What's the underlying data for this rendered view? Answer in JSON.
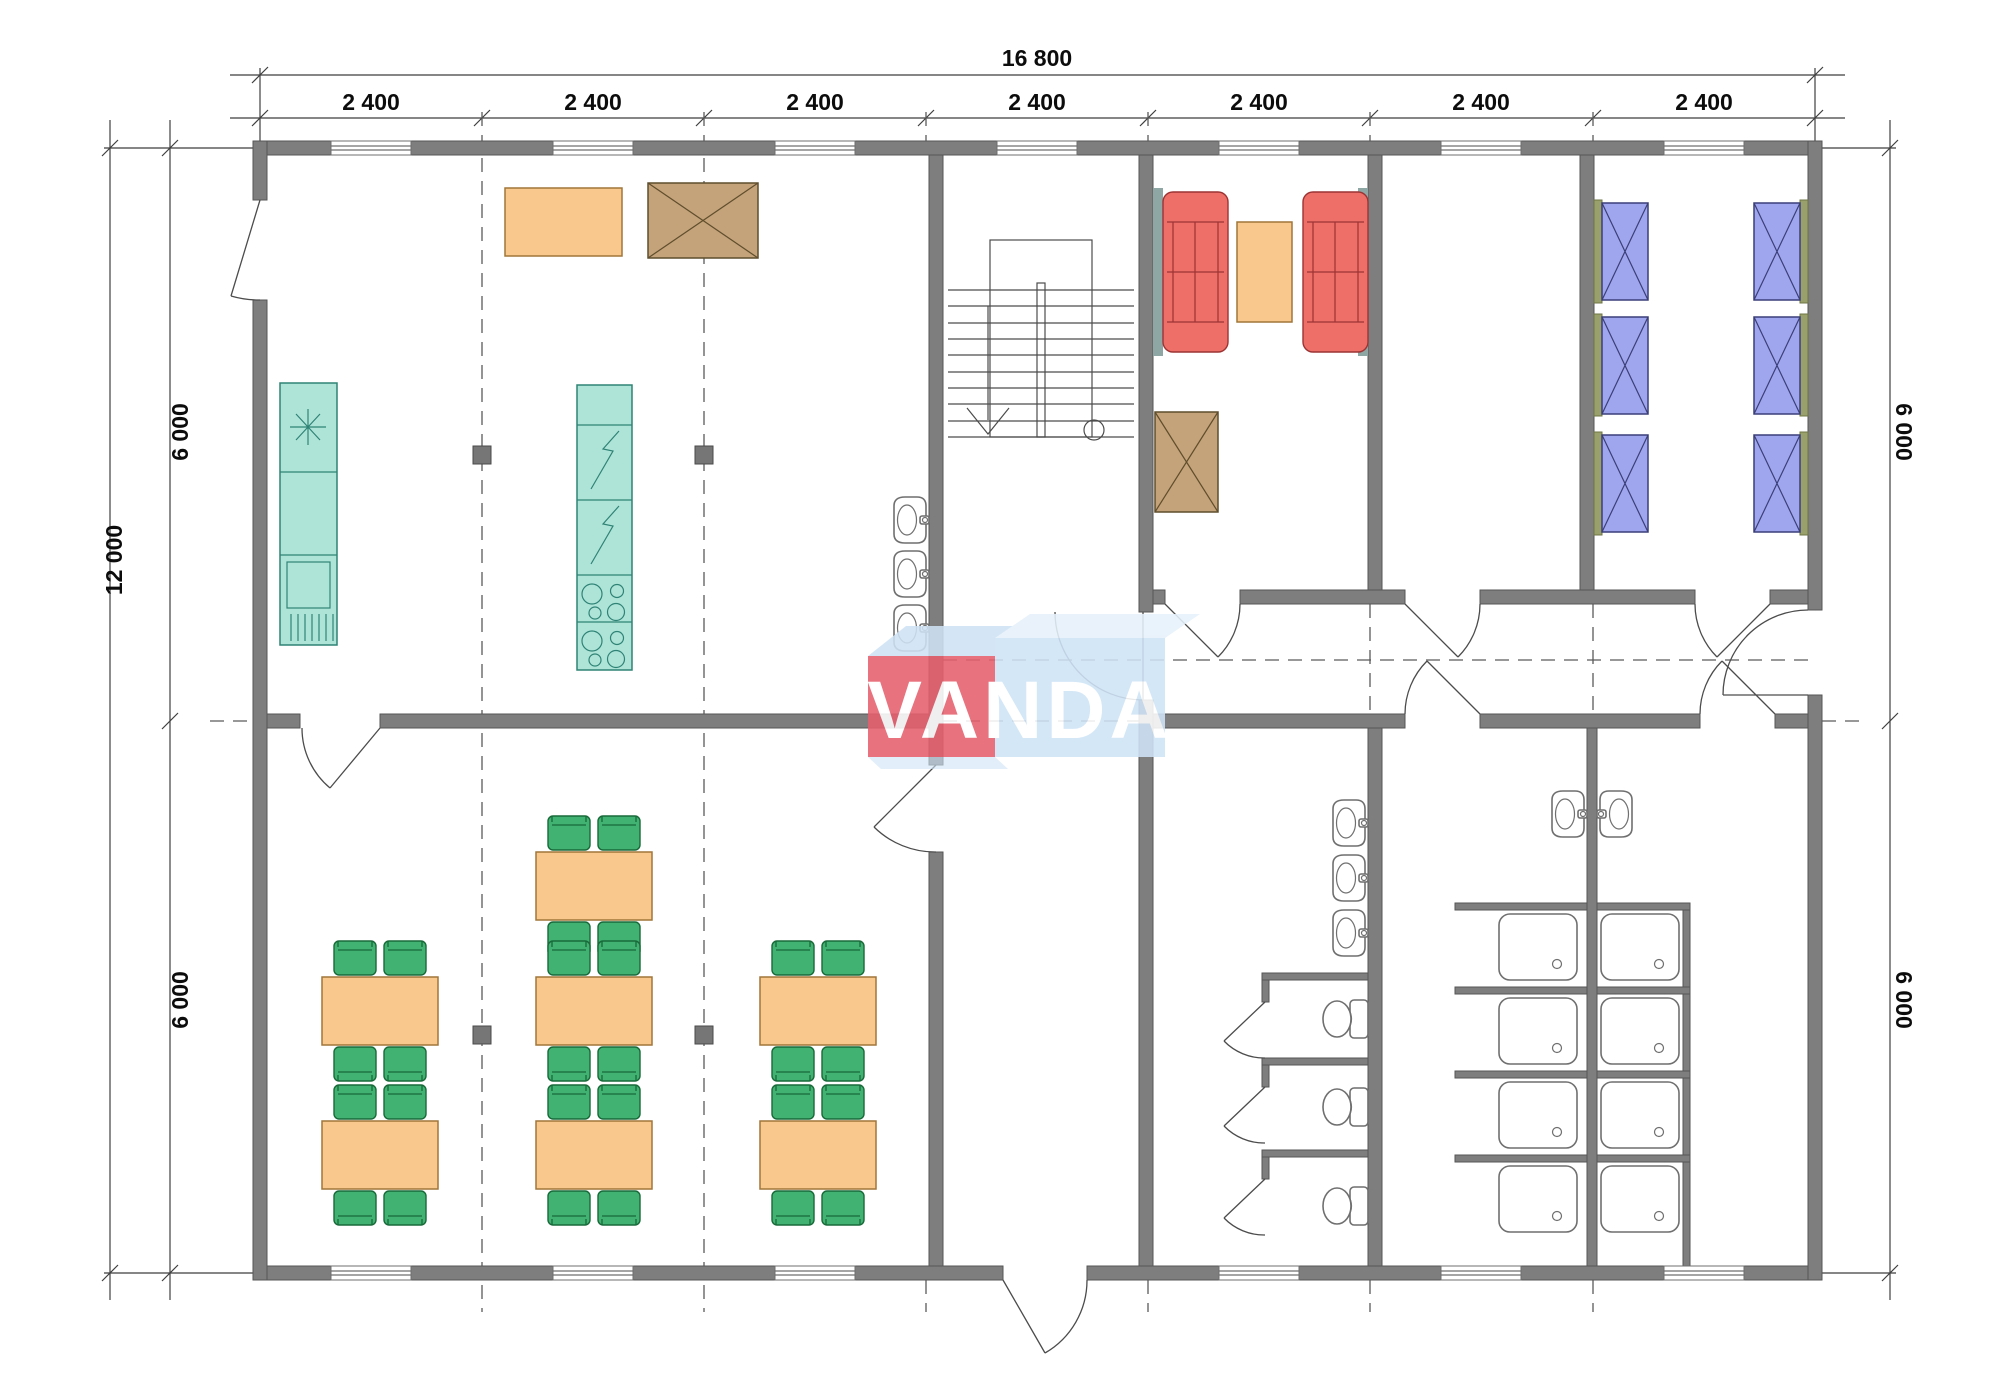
{
  "title": "Modular building floor plan",
  "watermark": {
    "text": "VANDA"
  },
  "dims": {
    "total_width": "16 800",
    "bays": [
      "2 400",
      "2 400",
      "2 400",
      "2 400",
      "2 400",
      "2 400",
      "2 400"
    ],
    "total_height": "12 000",
    "left_upper": "6 000",
    "left_lower": "6 000",
    "right_upper": "6 000",
    "right_lower": "6 000"
  },
  "symbols": {
    "dining_table_icon": "table-with-4-chairs",
    "bed_icon": "crossed-bed",
    "wardrobe_icon": "crossed-cabinet",
    "sofa_icon": "two-seat-sofa",
    "stair_icon": "staircase-with-down-arrow",
    "shower_icon": "shower-tray",
    "toilet_icon": "toilet-with-cistern",
    "basin_icon": "wash-basin",
    "cooktop_icon": "four-burner-hob",
    "sink_icon": "star-sink",
    "fridge_icon": "vented-appliance"
  },
  "colors": {
    "wall": "#7e7e7e",
    "wall-edge": "#565656",
    "line": "#4c4c4c",
    "fixture-line": "#6f6f6f",
    "furniture-orange": "#f9c88c",
    "furniture-orange-edge": "#a1763a",
    "chair-green": "#41b272",
    "chair-green-edge": "#186a39",
    "kitchen-teal": "#aee4d8",
    "kitchen-teal-edge": "#2f8375",
    "sofa-red": "#ee6f68",
    "sofa-red-edge": "#9c3434",
    "wardrobe-brown": "#c4a27a",
    "wardrobe-brown-edge": "#5f4e2c",
    "bed-blue": "#a0a6ee",
    "bed-blue-edge": "#3a3f78",
    "bed-rail-olive": "#9aa06b",
    "lounge-wall-strip": "#8ea6a4",
    "column-gray": "#767676",
    "dim-text": "#0c0c0c",
    "logo-red": "#e75f6e",
    "logo-red-top": "#cfe3f5",
    "logo-blue": "#cfe4f7",
    "logo-blue-top": "#e6f1fa",
    "logo-text": "#ffffff"
  }
}
